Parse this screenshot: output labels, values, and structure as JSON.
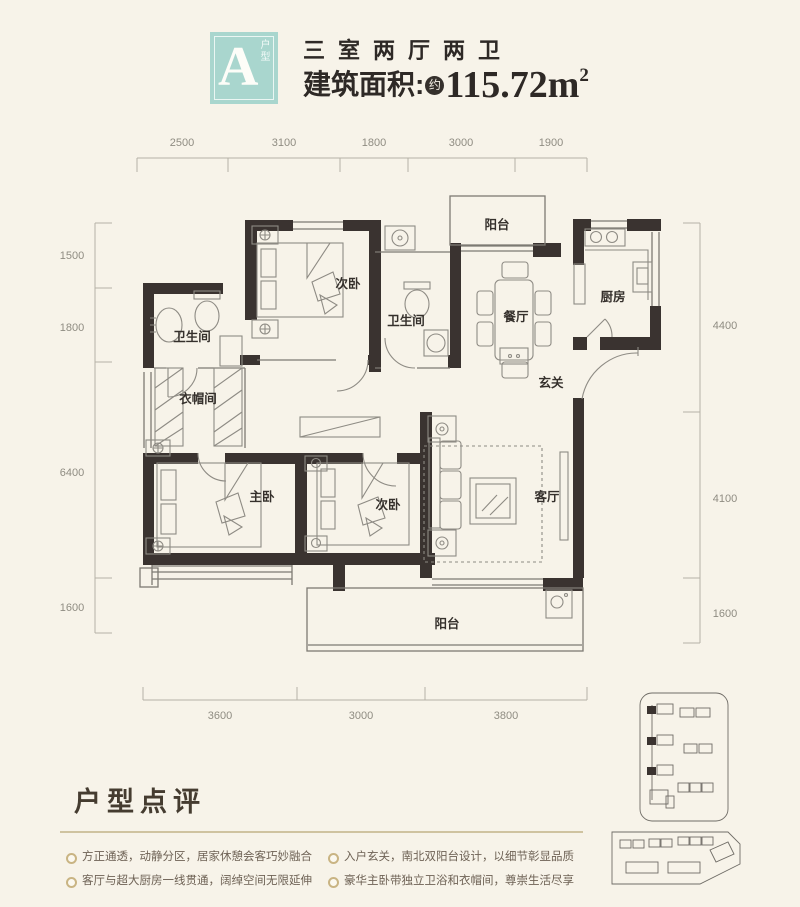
{
  "header": {
    "badge_letter": "A",
    "badge_caption": "户型",
    "title": "三室两厅两卫",
    "area_label": "建筑面积:",
    "area_circle": "约",
    "area_value": "115.72",
    "area_unit": "m",
    "area_exponent": "2"
  },
  "rooms": {
    "balcony_top": "阳台",
    "bedroom_top": "次卧",
    "bathroom_left": "卫生间",
    "bathroom_mid": "卫生间",
    "dining": "餐厅",
    "kitchen": "厨房",
    "foyer": "玄关",
    "cloakroom": "衣帽间",
    "master_bedroom": "主卧",
    "bedroom_bottom": "次卧",
    "living": "客厅",
    "balcony_bottom": "阳台"
  },
  "dims": {
    "top": [
      "2500",
      "3100",
      "1800",
      "3000",
      "1900"
    ],
    "left": [
      "1500",
      "1800",
      "6400",
      "1600"
    ],
    "right": [
      "4400",
      "4100",
      "1600"
    ],
    "bottom": [
      "3600",
      "3000",
      "3800"
    ]
  },
  "review": {
    "heading": "户型点评",
    "bullets": [
      "方正通透，动静分区，居家休憩会客巧妙融合",
      "客厅与超大厨房一线贯通，阔绰空间无限延伸",
      "入户玄关，南北双阳台设计，以细节彰显品质",
      "豪华主卧带独立卫浴和衣帽间，尊崇生活尽享"
    ]
  },
  "colors": {
    "background": "#f7f3e9",
    "badge": "#a9d6ce",
    "wall": "#3a3330",
    "accent_gold": "#c9b483",
    "text_dark": "#35302c",
    "text_brown": "#6e6255",
    "dim_text": "#8f8c82"
  }
}
